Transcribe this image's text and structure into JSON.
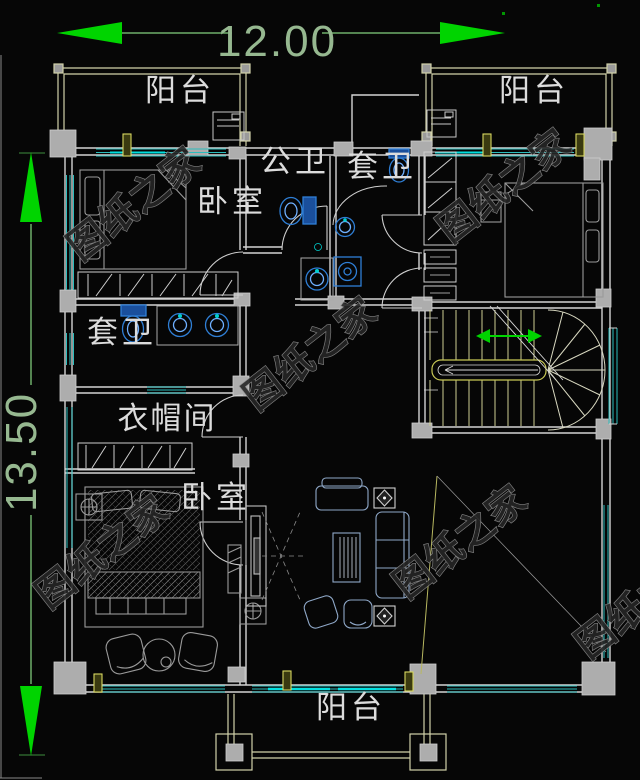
{
  "canvas": {
    "background": "#060606"
  },
  "dimensions": {
    "width_label": "12.00",
    "height_label": "13.50"
  },
  "rooms": {
    "balcony_top_left": "阳台",
    "balcony_top_right": "阳台",
    "balcony_bottom": "阳台",
    "public_bathroom": "公卫",
    "ensuite_bathroom_top": "套卫",
    "ensuite_bathroom_left": "套卫",
    "bedroom_top_left": "卧室",
    "bedroom_bottom_left": "卧室",
    "cloakroom": "衣帽间"
  },
  "watermark": {
    "text": "图纸之家"
  },
  "colors": {
    "dimension_arrow": "#00d400",
    "dimension_text": "#96b890",
    "wall": "#d4d4d4",
    "window": "#2bbdbd",
    "window_bright": "#00e0e0",
    "stair_yellow": "#cfcf92",
    "fixture_blue": "#2f7fd6",
    "column_fill": "#adadad",
    "watermark_gray": "#8f8f8f"
  }
}
